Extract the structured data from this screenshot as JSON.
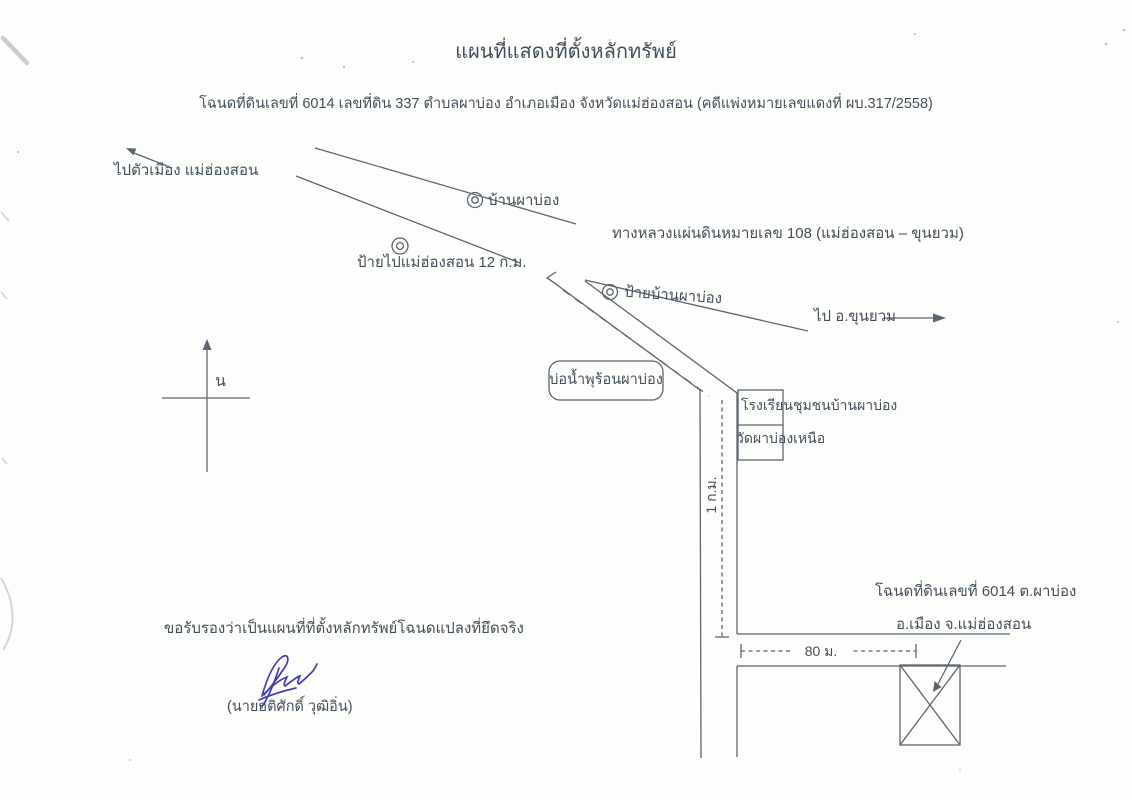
{
  "doc": {
    "title": "แผนที่แสดงที่ตั้งหลักทรัพย์",
    "subtitle": "โฉนดที่ดินเลขที่ 6014 เลขที่ดิน 337 ตำบลผาบ่อง  อำเภอเมือง จังหวัดแม่ฮ่องสอน (คดีแพ่งหมายเลขแดงที่ ผบ.317/2558)"
  },
  "map": {
    "to_city_label": "ไปตัวเมือง แม่ฮ่องสอน",
    "village_label": "บ้านผาบ่อง",
    "highway_label": "ทางหลวงแผ่นดินหมายเลข 108 (แม่ฮ่องสอน – ขุนยวม)",
    "sign_12km_label": "ป้ายไปแม่ฮ่องสอน 12 ก.ม.",
    "sign_village_label": "ป้ายบ้านผาบ่อง",
    "to_khunyuam_label": "ไป อ.ขุนยวม",
    "north_label": "น",
    "hot_spring_label": "บ่อน้ำพุร้อนผาบ่อง",
    "school_label": "โรงเรียนชุมชนบ้านผาบ่อง",
    "temple_label": "วัดผาบ่องเหนือ",
    "distance_1km_label": "1 ก.ม.",
    "distance_80m_label": "80 ม.",
    "deed_location_line1": "โฉนดที่ดินเลขที่ 6014  ต.ผาบ่อง",
    "deed_location_line2": "อ.เมือง จ.แม่ฮ่องสอน"
  },
  "certification": {
    "statement": "ขอรับรองว่าเป็นแผนที่ที่ตั้งหลักทรัพย์โฉนดแปลงที่ยึดจริง",
    "signer_name": "(นายอติศักดิ์  วุฒิอิ่น)"
  },
  "colors": {
    "ink": "#43505c",
    "line": "#5b6671",
    "signature_ink": "#3f3fae",
    "paper": "#fdfdfb"
  }
}
